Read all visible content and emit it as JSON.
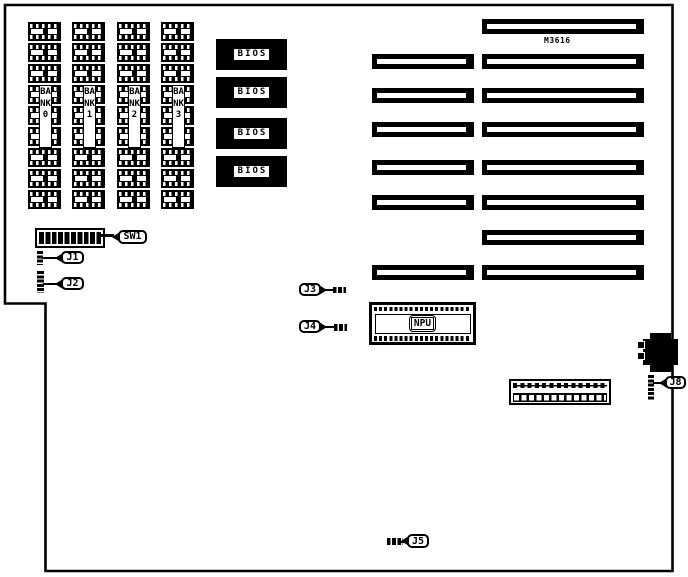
{
  "board": {
    "model": "M3616",
    "banks": [
      {
        "label": "BANK0"
      },
      {
        "label": "BANK1"
      },
      {
        "label": "BANK2"
      },
      {
        "label": "BANK3"
      }
    ],
    "bios": [
      {
        "label": "BIOS"
      },
      {
        "label": "BIOS"
      },
      {
        "label": "BIOS"
      },
      {
        "label": "BIOS"
      }
    ],
    "npu": {
      "label": "NPU"
    },
    "callouts": {
      "sw1": {
        "label": "SW1"
      },
      "j1": {
        "label": "J1"
      },
      "j2": {
        "label": "J2"
      },
      "j3": {
        "label": "J3"
      },
      "j4": {
        "label": "J4"
      },
      "j5": {
        "label": "J5"
      },
      "j8": {
        "label": "J8"
      }
    },
    "colors": {
      "outline": "#000000",
      "background": "#ffffff"
    }
  }
}
